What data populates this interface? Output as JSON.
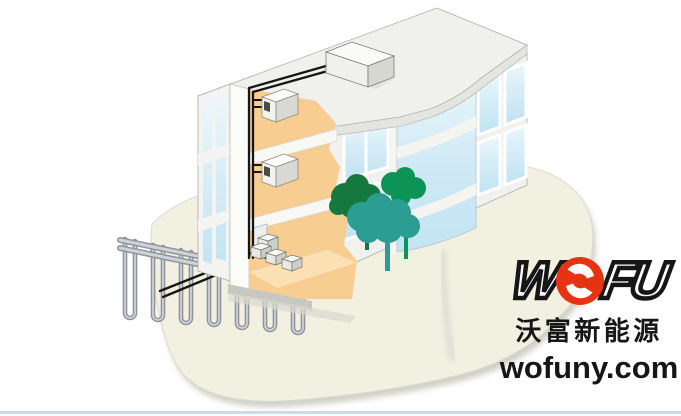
{
  "page": {
    "width": 681,
    "height": 416,
    "background": "#ffffff"
  },
  "logo": {
    "brand_w": "W",
    "brand_fu": "FU",
    "chinese_name": "沃富新能源",
    "website": "wofuny.com"
  },
  "colors": {
    "background": "#ffffff",
    "bottom_rule": "#ccdaec",
    "ground": "#f1f0e1",
    "ground_shadow": "#c9c8bc",
    "building_wall": "#f3f4f1",
    "roof_top": "#f0f0ed",
    "interior_wall": "#f8cd92",
    "interior_floor": "#fbe0b4",
    "pipe_black": "#161616",
    "loop_pipe": "#8f949c",
    "loop_pipe_light": "#cfd2d6",
    "tree_dark": "#15793f",
    "tree_green": "#0d9355",
    "tree_teal": "#2b9d93",
    "logo_red": "#e63312",
    "logo_black": "#161616"
  },
  "scene": {
    "parts": [
      "office-building-cutaway",
      "roof-slab",
      "rooftop-outdoor-unit",
      "indoor-unit-level-3",
      "indoor-unit-level-2",
      "basement-heat-pump-units",
      "pipe-riser",
      "underground-header-pipes",
      "borehole-u-tube-loops",
      "glass-curtain-tower",
      "trees",
      "ground-mound"
    ]
  }
}
